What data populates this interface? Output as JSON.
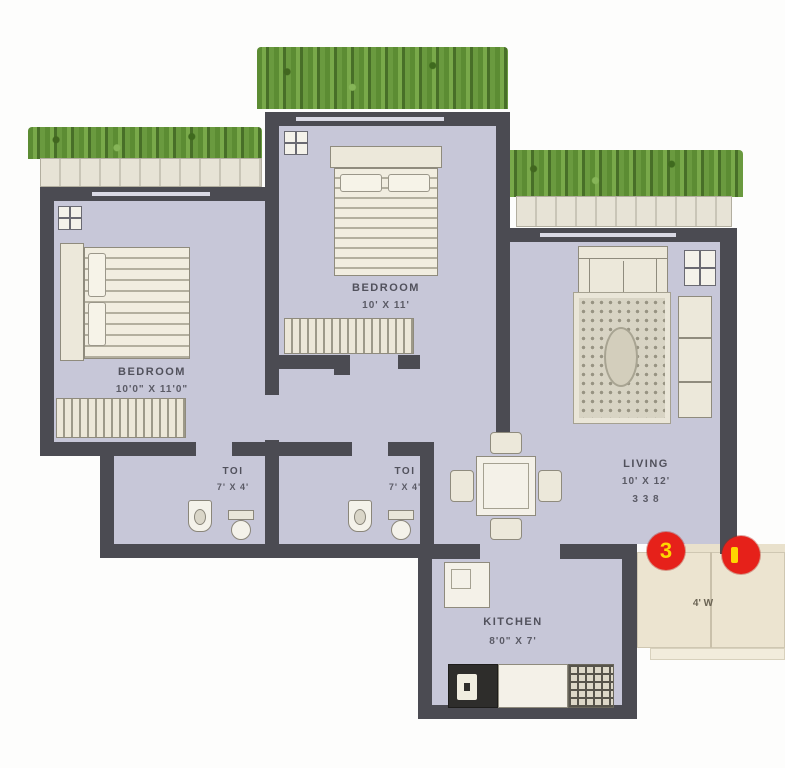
{
  "rooms": {
    "bedroom1": {
      "label": "BEDROOM",
      "dims": "10'0\" X 11'0\""
    },
    "bedroom2": {
      "label": "BEDROOM",
      "dims": "10' X 11'"
    },
    "living": {
      "label": "LIVING",
      "dims": "10' X 12'",
      "dims_metric": "3 3 8"
    },
    "toilet1": {
      "label": "TOI",
      "dims": "7' X 4'"
    },
    "toilet2": {
      "label": "TOI",
      "dims": "7' X 4'"
    },
    "kitchen": {
      "label": "KITCHEN",
      "dims": "8'0\" X 7'"
    },
    "balcony": {
      "dims": "4' W"
    }
  },
  "markers": {
    "m3": "3"
  },
  "colors": {
    "wall": "#4b4b52",
    "floor": "#c7c7d8",
    "balcony": "#ece4d0",
    "plant_green": "#6a9a3f",
    "marker_red": "#e6211a",
    "marker_number": "#ffd600"
  }
}
